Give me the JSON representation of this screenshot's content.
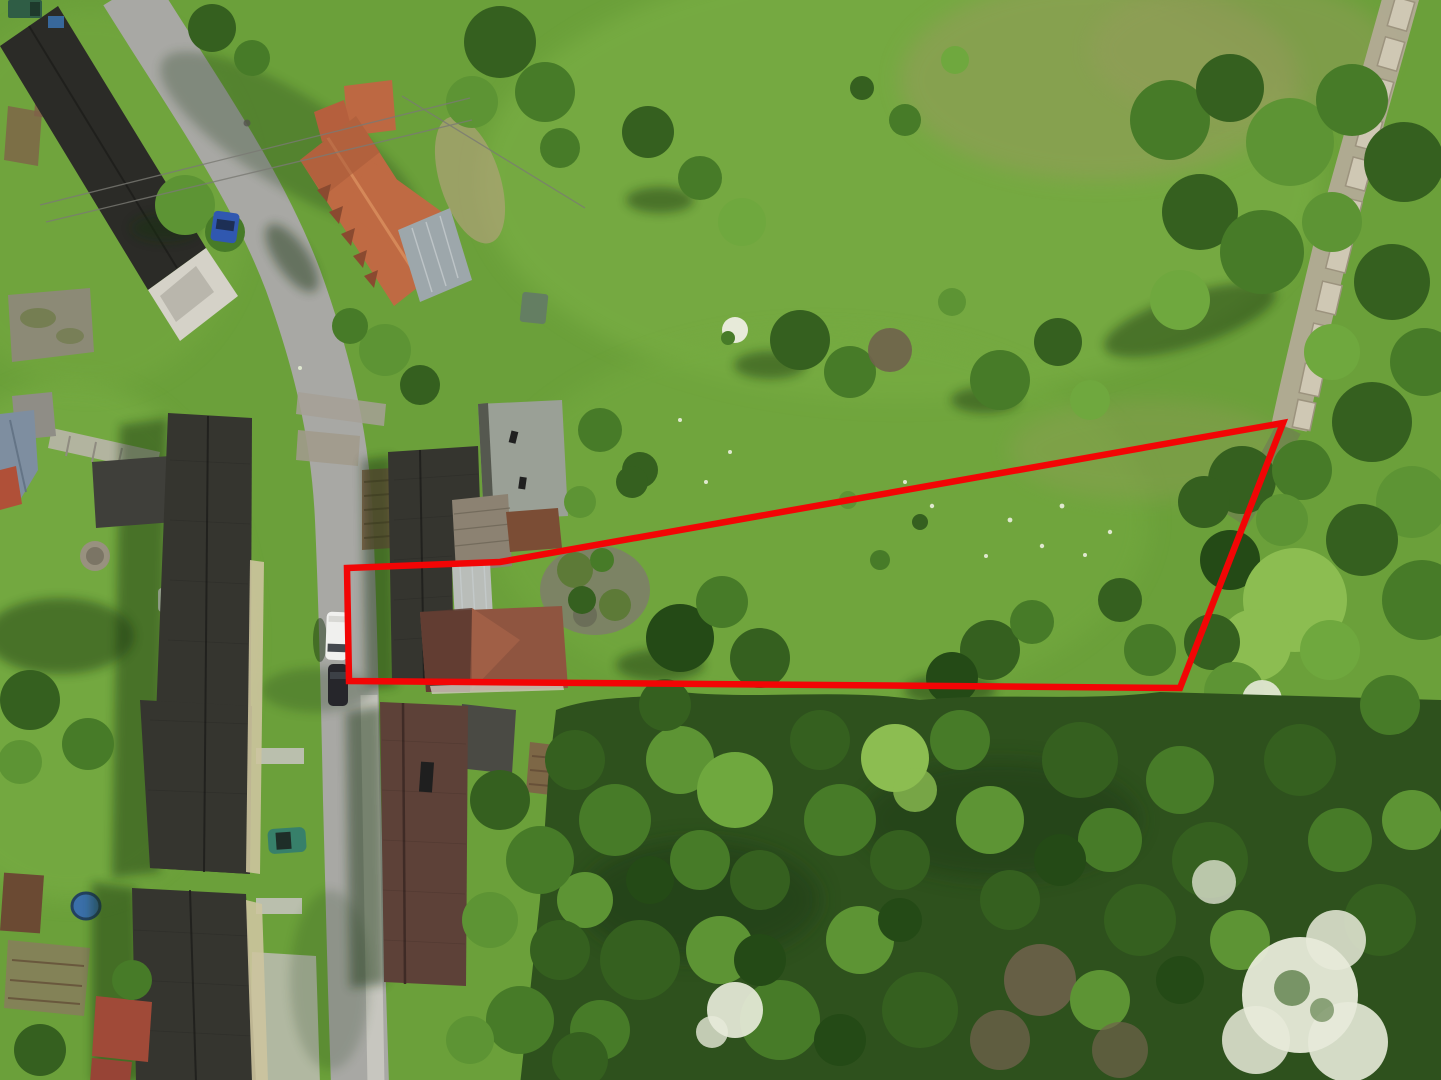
{
  "scene": {
    "type": "aerial-drone-photo",
    "description": "Top-down drone photograph of a village street with houses on the left, a large green meadow and woodland on the right, and a red outline marking a land parcel for sale.",
    "canvas": {
      "width": 1441,
      "height": 1080
    },
    "boundary": {
      "label": "property-boundary",
      "color": "#f20505",
      "stroke_width": 6.5,
      "points": "347,568 500,562 1283,423 1180,688 349,681",
      "vertices": [
        [
          347,
          568
        ],
        [
          500,
          562
        ],
        [
          1283,
          423
        ],
        [
          1180,
          688
        ],
        [
          349,
          681
        ]
      ]
    },
    "colors": {
      "meadow": "#6ba03a",
      "meadow_light": "#7eb247",
      "forest": "#2e511d",
      "road": "#a8a8a4",
      "sidewalk": "#c7c6bf",
      "slab_path": "#b3ab96",
      "roof_dark": "#35352f",
      "roof_black": "#2b2b27",
      "roof_terracotta": "#bf6a43",
      "roof_metal": "#9da7ab",
      "roof_flat_gray": "#9aa096",
      "roof_brown": "#5d4138",
      "roof_plank": "#8c8272",
      "roof_rust": "#7b4d35",
      "facade": "#cdc49f",
      "van_white": "#f0f0ee",
      "car_dark": "#26262b",
      "car_teal": "#37806a",
      "car_blue": "#3058b0",
      "truck_green": "#2f5d45",
      "soil": "#7f6148",
      "pool_blue": "#3a6fa8"
    },
    "objects": [
      {
        "name": "property-boundary",
        "type": "red-outline-overlay"
      },
      {
        "name": "village-road",
        "type": "asphalt-road"
      },
      {
        "name": "sidewalk",
        "type": "concrete-path"
      },
      {
        "name": "slab-footpath",
        "type": "concrete-slab-trail"
      },
      {
        "name": "terracotta-roof-house",
        "type": "building"
      },
      {
        "name": "farmstead-complex",
        "type": "building-group-inside-boundary"
      },
      {
        "name": "apartment-block-north",
        "type": "building"
      },
      {
        "name": "apartment-block-south",
        "type": "building"
      },
      {
        "name": "brown-roof-house",
        "type": "building"
      },
      {
        "name": "black-roof-house",
        "type": "building"
      },
      {
        "name": "mossy-barn",
        "type": "building"
      },
      {
        "name": "white-van",
        "type": "vehicle"
      },
      {
        "name": "dark-car",
        "type": "vehicle"
      },
      {
        "name": "teal-car",
        "type": "vehicle"
      },
      {
        "name": "blue-car",
        "type": "vehicle"
      },
      {
        "name": "green-truck",
        "type": "vehicle"
      },
      {
        "name": "meadow",
        "type": "grassland"
      },
      {
        "name": "woodland",
        "type": "forest"
      },
      {
        "name": "blossom-trees",
        "type": "white-flowering-trees"
      }
    ]
  }
}
